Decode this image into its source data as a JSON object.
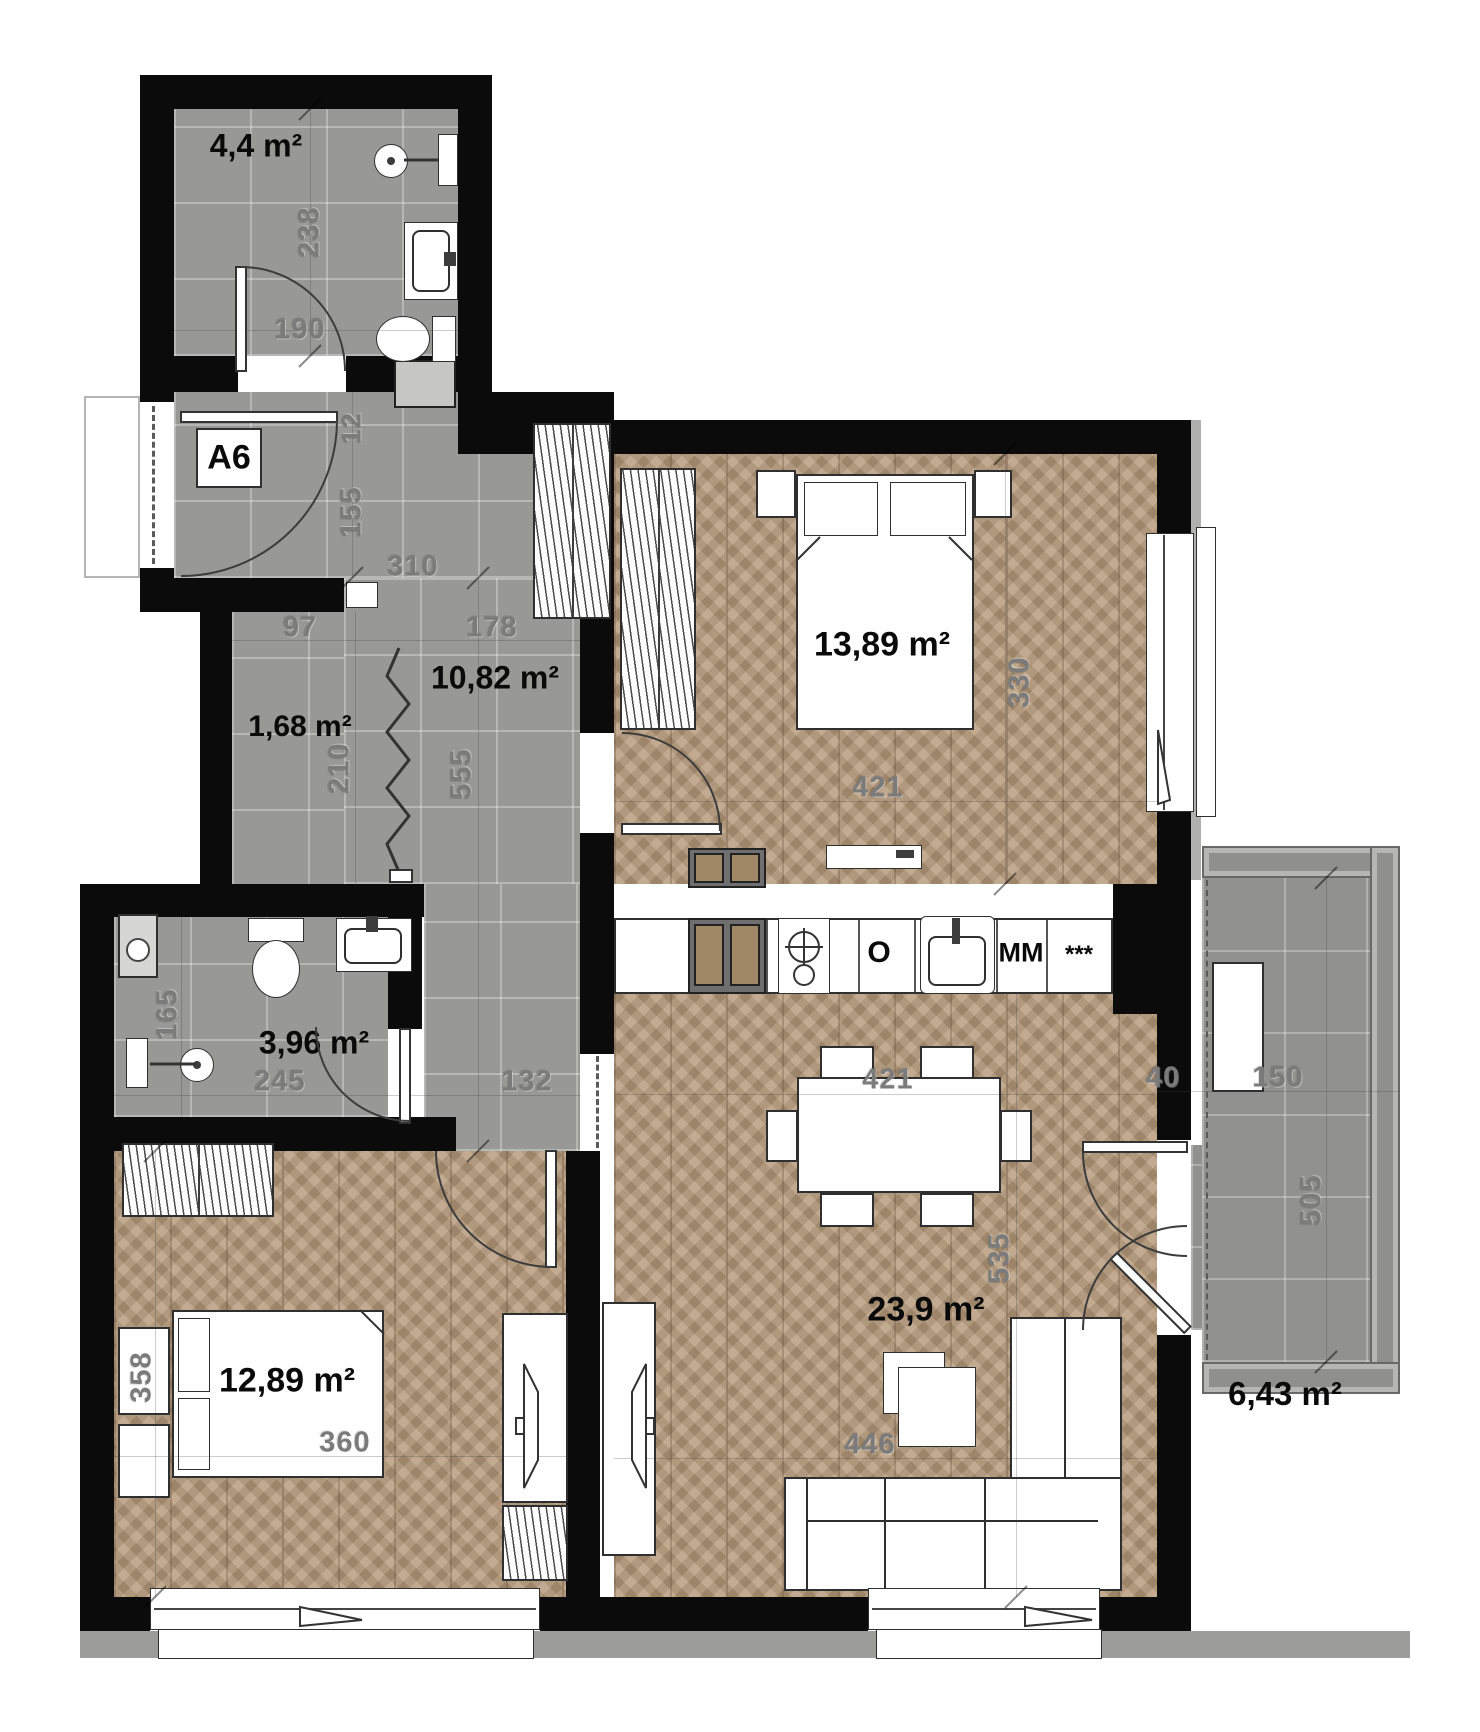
{
  "palette": {
    "wall": "#0b0b0b",
    "tile_floor": "#989896",
    "wood_floor": "#b49879",
    "balcony_tile": "#91918f",
    "sidewalk": "#9c9c9a",
    "railing": "#8f8f8d",
    "dim_text": "#7b7b7b",
    "label_text": "#0a0a0a"
  },
  "labels": {
    "apartment": "A6",
    "bath_top": "4,4 m²",
    "hall": "10,82 m²",
    "closet": "1,68 m²",
    "bed_right": "13,89 m²",
    "bath_main": "3,96 m²",
    "bed_left": "12,89 m²",
    "living": "23,9 m²",
    "balcony": "6,43 m²",
    "oven": "O",
    "microwave": "MM",
    "fridge": "***"
  },
  "dims": {
    "bath_top_h": "238",
    "bath_top_w": "190",
    "entry_niche": "12",
    "entry_door": "155",
    "vestibule_w": "310",
    "hall_seg": "97",
    "hall_w": "178",
    "hall_h": "555",
    "closet_h": "210",
    "bath_main_h": "165",
    "bath_main_w": "245",
    "corridor_w": "132",
    "bed_right_h": "330",
    "bed_right_w": "421",
    "living_w": "421",
    "living_h": "535",
    "living_w2": "446",
    "bed_left_h": "358",
    "bed_left_w": "360",
    "balcony_gap": "40",
    "balcony_w": "150",
    "balcony_h": "505"
  }
}
